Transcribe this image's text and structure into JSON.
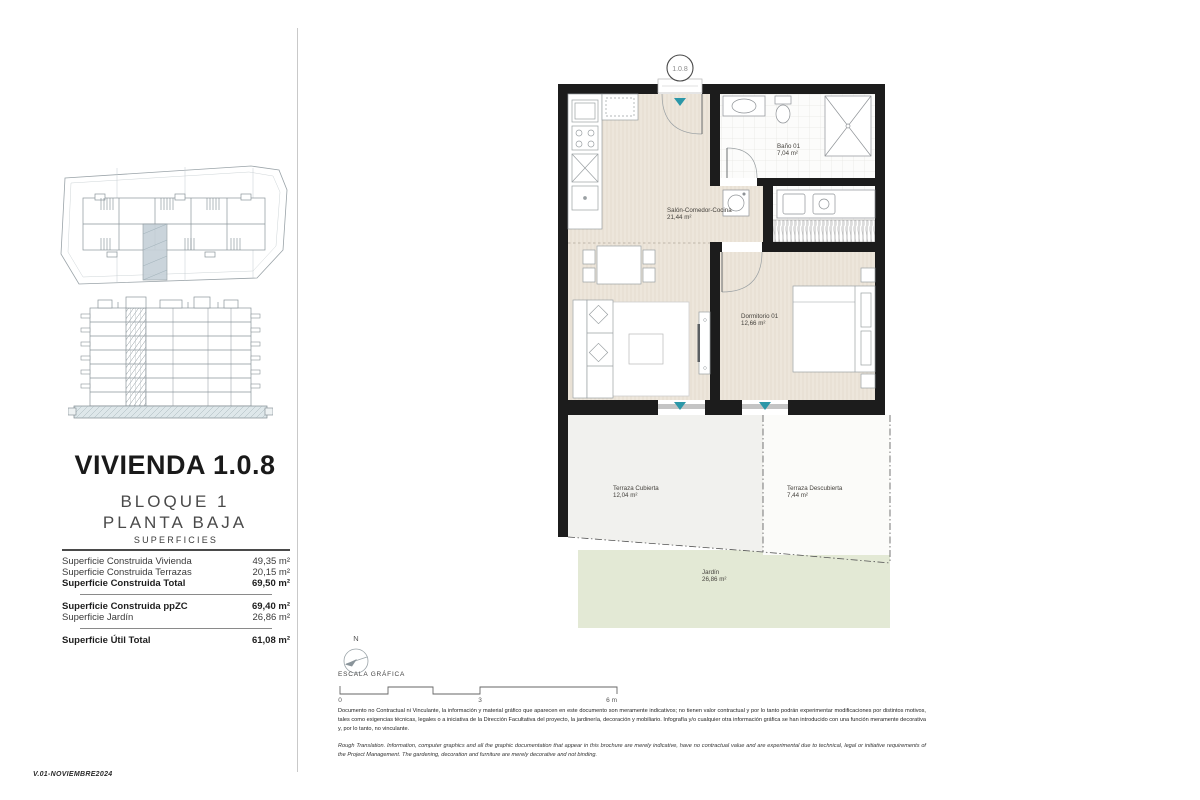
{
  "document": {
    "version": "V.01-NOVIEMBRE2024"
  },
  "sidebar": {
    "title": "VIVIENDA 1.0.8",
    "subtitle1": "BLOQUE 1",
    "subtitle2": "PLANTA BAJA",
    "surfaces": {
      "heading": "SUPERFICIES",
      "rows": [
        {
          "label": "Superficie Construida Vivienda",
          "value": "49,35 m²"
        },
        {
          "label": "Superficie Construida Terrazas",
          "value": "20,15 m²"
        },
        {
          "label": "Superficie Construida Total",
          "value": "69,50 m²"
        },
        {
          "label": "Superficie Construida ppZC",
          "value": "69,40 m²"
        },
        {
          "label": "Superficie Jardín",
          "value": "26,86 m²"
        },
        {
          "label": "Superficie Útil Total",
          "value": "61,08 m²"
        }
      ]
    }
  },
  "plan": {
    "unit_badge": "1.0.8",
    "rooms": {
      "salon": {
        "name": "Salón-Comedor-Cocina",
        "area": "21,44 m²"
      },
      "bano": {
        "name": "Baño 01",
        "area": "7,04 m²"
      },
      "dormitorio": {
        "name": "Dormitorio 01",
        "area": "12,66 m²"
      },
      "terraza_cubierta": {
        "name": "Terraza Cubierta",
        "area": "12,04 m²"
      },
      "terraza_descubierta": {
        "name": "Terraza Descubierta",
        "area": "7,44 m²"
      },
      "jardin": {
        "name": "Jardín",
        "area": "26,86 m²"
      }
    }
  },
  "legend": {
    "north": "N",
    "scale_label": "ESCALA GRÁFICA",
    "ticks": [
      "0",
      "3",
      "6 m"
    ]
  },
  "disclaimer": {
    "es": "Documento no Contractual ni Vinculante, la información y material gráfico que aparecen en este documento son meramente indicativos; no tienen valor contractual y por lo tanto podrán experimentar modificaciones por distintos motivos, tales como exigencias técnicas, legales o a iniciativa de la Dirección Facultativa del proyecto, la jardinería, decoración y mobiliario. Infografía y/o cualquier otra información gráfica se han introducido con una función meramente decorativa y, por lo tanto, no vinculante.",
    "en": "Rough Translation. Information, computer graphics and all the graphic documentation that appear in this brochure are merely indicative, have no contractual value and are experimental due to technical, legal or initiative requirements of the Project Management. The gardening, decoration and furniture are merely decorative and not binding."
  },
  "colors": {
    "accent_teal": "#2B97A8",
    "wall_black": "#1C1C1C",
    "wood_floor": "#EDE6DB",
    "terrace_grey": "#F1F1EE",
    "garden_green": "#E3E9D5",
    "keyplan_highlight": "#C6D1D8"
  }
}
